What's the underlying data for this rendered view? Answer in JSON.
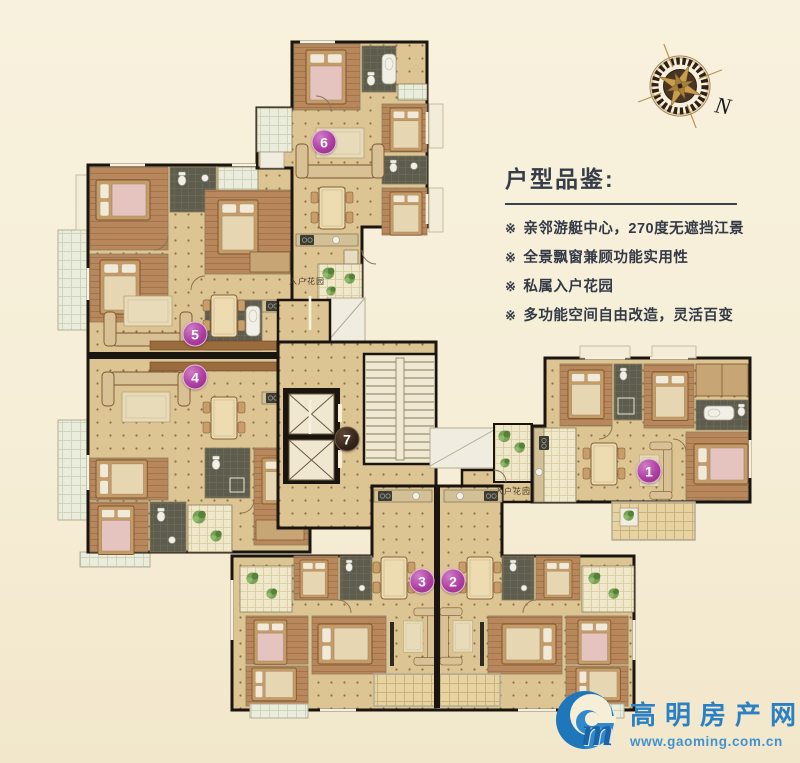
{
  "info_panel": {
    "title": "户型品鉴:",
    "features": [
      {
        "bullet": "※",
        "text": "亲邻游艇中心，270度无遮挡江景"
      },
      {
        "bullet": "※",
        "text": "全景飘窗兼顾功能实用性"
      },
      {
        "bullet": "※",
        "text": "私属入户花园"
      },
      {
        "bullet": "※",
        "text": "多功能空间自由改造，灵活百变"
      }
    ]
  },
  "compass": {
    "north_label": "N"
  },
  "plan": {
    "entry_garden_label": "入户花园",
    "units": [
      {
        "number": "1"
      },
      {
        "number": "2"
      },
      {
        "number": "3"
      },
      {
        "number": "4"
      },
      {
        "number": "5"
      },
      {
        "number": "6"
      },
      {
        "number": "7"
      }
    ],
    "colors": {
      "unit_marker": "#ae3fa2",
      "unit_marker_7": "#35241a",
      "walls": "#1b1510",
      "floor_tan": "#dcc593",
      "wood_floor": "#b8885c",
      "bath_tile": "#5e5c4d",
      "balcony": "#eaecdc",
      "background": "#f6eed7"
    }
  },
  "watermark": {
    "logo_monogram": "m",
    "site_name": "高明房产网",
    "site_url": "www.gaoming.com.cn",
    "brand_color": "#2b80c3"
  }
}
